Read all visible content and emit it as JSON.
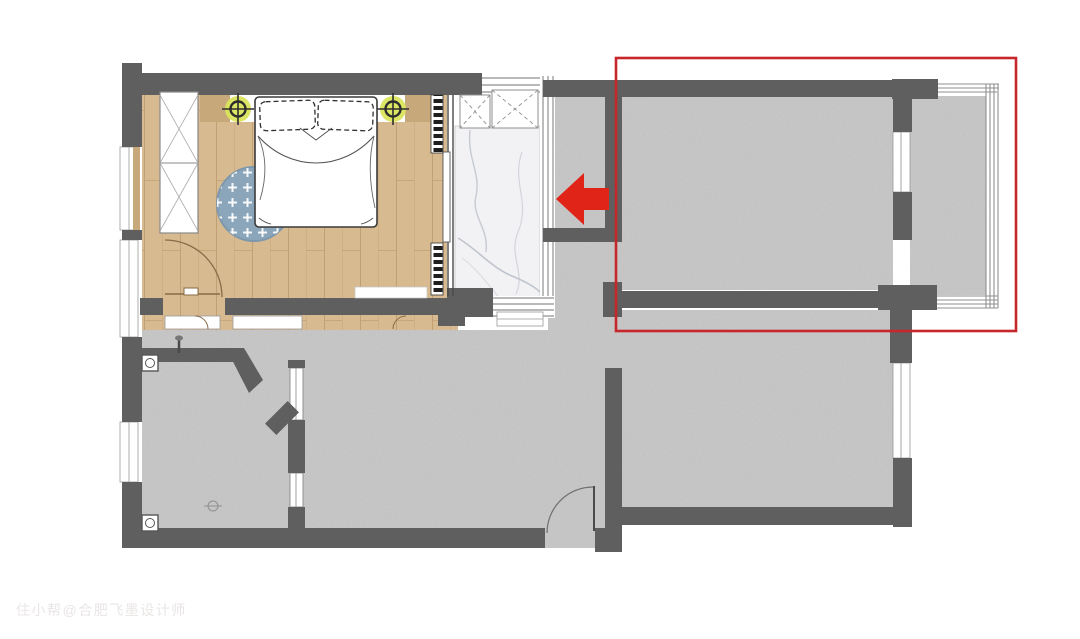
{
  "watermark": {
    "text": "住小帮@合肥飞墨设计师"
  },
  "annotations": {
    "highlight_box_color": "#c7272a",
    "arrow_color": "#e02418",
    "arrow_direction": "left",
    "highlight_area": "top-right rooms"
  },
  "palette": {
    "background": "#ffffff",
    "wall": "#5f5f5f",
    "concrete_floor": "#cbcbcb",
    "wood_floor": "#d7ba90",
    "marble_floor": "#f2f2f4",
    "rug": "#8ba6ba",
    "ceiling_light_glow": "#dbe45c",
    "window_sill": "#c7a87b"
  },
  "icons": {
    "red_arrow": "left-arrow",
    "ceiling_light": "downlight-target",
    "floor_drain": "square-with-circle",
    "door": "quarter-arc-swing",
    "radiator": "dash-strip",
    "wardrobe": "x-panel-cabinet"
  }
}
